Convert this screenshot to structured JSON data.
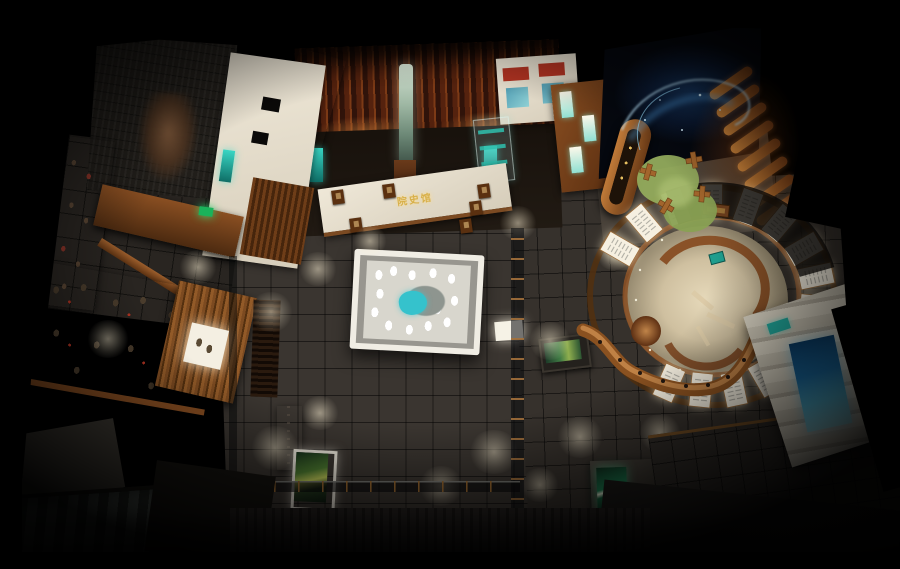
{
  "scene": {
    "sign": {
      "text": "院史馆"
    },
    "colors": {
      "background": "#000000",
      "floor_tile": "#3a3530",
      "wood_copper": "#9c5e2c",
      "cream_wall": "#e8e0d0",
      "teal_accent": "#27b3a8",
      "sand_table_lake": "#35c2cc",
      "projection_glow": "#9fd8ff",
      "rug_green": "#8fa757",
      "exit_green": "#2ed06e",
      "screen_green": "#1e7f52",
      "screen_blue": "#2a7fb5",
      "gold_sign": "#d8b04a"
    }
  }
}
